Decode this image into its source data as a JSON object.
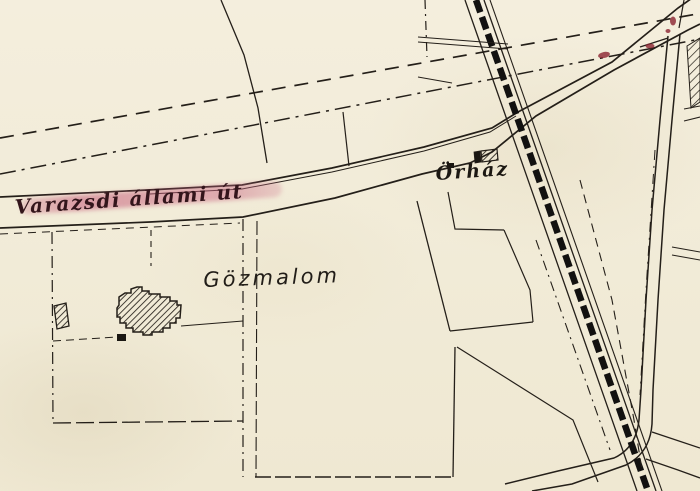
{
  "map": {
    "kind": "historical-cadastral-map-scan",
    "labels": {
      "road": "Varazsdi állami út",
      "mill": "Gözmalom",
      "guardhouse": "Örház"
    },
    "colors": {
      "paper": "#f1ebd7",
      "ink": "#241f19",
      "railway_band": "#121110",
      "road_label_ink": "#33151b",
      "road_highlight_pink": "#c65c7a",
      "stain_red": "#8c2431"
    },
    "features": [
      {
        "name": "state-road",
        "label_ref": "road"
      },
      {
        "name": "railway-line"
      },
      {
        "name": "steam-mill-building",
        "label_ref": "mill"
      },
      {
        "name": "guardhouse-building",
        "label_ref": "guardhouse"
      },
      {
        "name": "parcel-boundaries"
      },
      {
        "name": "survey-dashed-lines"
      }
    ]
  }
}
